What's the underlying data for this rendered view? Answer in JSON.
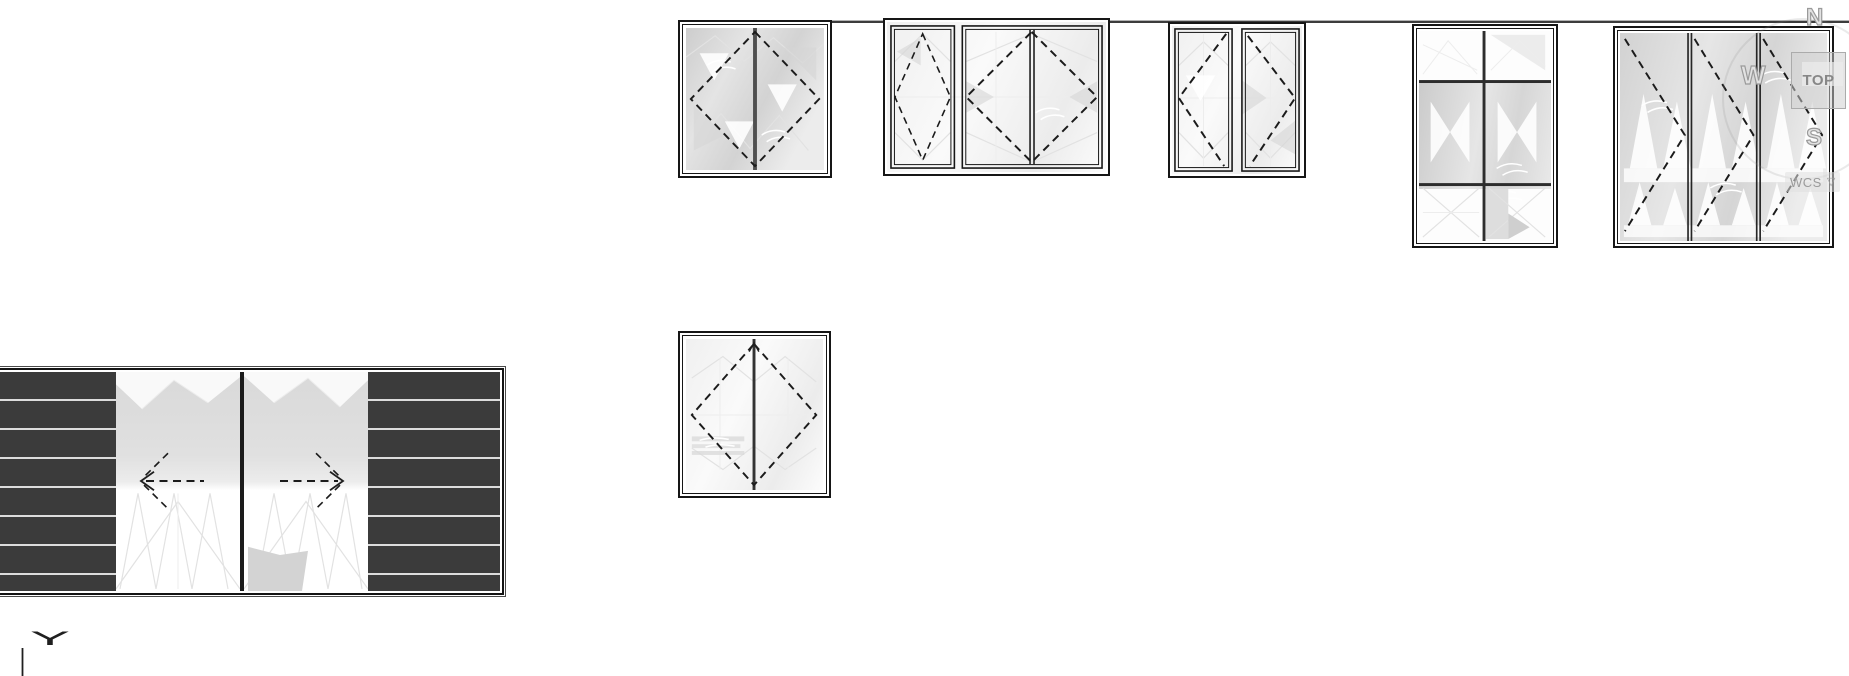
{
  "app": {
    "type": "cad-viewport",
    "background": "#ffffff"
  },
  "viewcube": {
    "top_label": "TOP",
    "north_label": "N",
    "west_label": "W",
    "south_label": "S",
    "wcs_label": "WCS",
    "dropdown_glyph": "▽"
  },
  "axis_indicator": {
    "label": "Y"
  },
  "colors": {
    "frame_line": "#161616",
    "wall_line": "#3c3c3c",
    "dashed_symbol": "#1b1b1b",
    "glass_shade": "#d3d3d3",
    "glass_light": "#f5f5f5",
    "louver_panel_dark": "#3b3b3b",
    "louver_separator": "#dcdcdc",
    "viewcube_text": "#878787",
    "viewcube_face": "#cecece"
  },
  "drawings": {
    "wall_line": {
      "name": "wall-line",
      "orientation": "horizontal"
    },
    "windows": [
      {
        "id": "window-1",
        "type": "double-casement-elevation",
        "opening_symbol": "dashed-diamond",
        "mullion": "center-vertical"
      },
      {
        "id": "window-2",
        "type": "narrow-sash-plus-double-casement-elevation",
        "opening_symbol": "dashed-diamonds"
      },
      {
        "id": "window-3",
        "type": "twin-casement-elevation",
        "opening_symbol": "dashed-chevrons-outward"
      },
      {
        "id": "window-4",
        "type": "fixed-six-pane-elevation",
        "grid": "2x3"
      },
      {
        "id": "window-5",
        "type": "three-panel-folding-elevation",
        "opening_symbol": "dashed-chevrons-right"
      },
      {
        "id": "window-6",
        "type": "double-casement-elevation",
        "opening_symbol": "dashed-diamond-with-top-arrow"
      }
    ],
    "sliding_door_plan": {
      "id": "sliding-door-plan",
      "panels": [
        "louver-left",
        "glass-slider-left",
        "glass-slider-right",
        "louver-right"
      ],
      "slide_arrows": [
        "left",
        "right"
      ]
    }
  }
}
